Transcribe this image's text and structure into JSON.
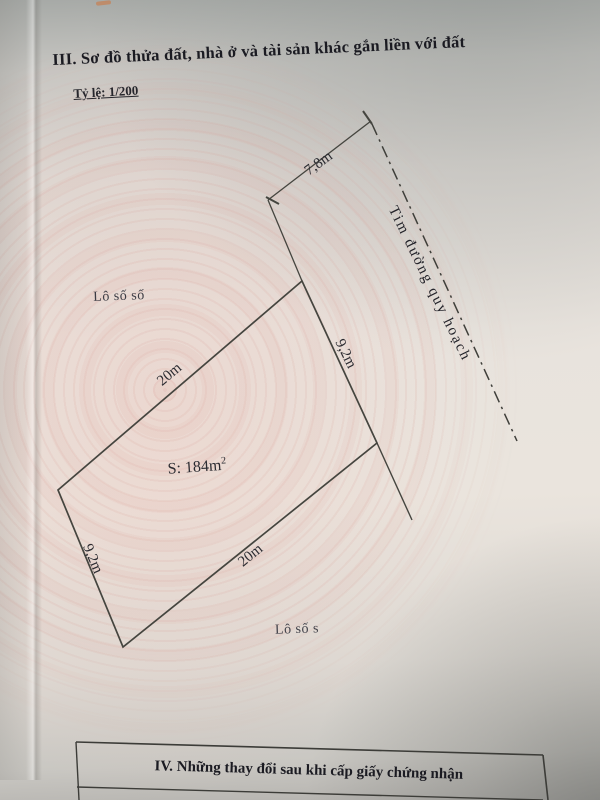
{
  "photo": {
    "section3_heading": "III. Sơ đồ thửa đất, nhà ở và tài sản khác gắn liền với đất",
    "scale_label": "Tỷ lệ: 1/200",
    "diagram": {
      "road_centerline_label": "Tim đường quy hoạch",
      "frontage_offset": "7,8m",
      "edge_top": "20m",
      "side_right": "9,2m",
      "side_left": "9,2m",
      "edge_bottom": "20m",
      "area_label": "S: 184m",
      "area_superscript": "2",
      "adjacent_lot_top": "Lô số số",
      "adjacent_lot_bottom": "Lô số s"
    },
    "section4_heading": "IV. Những thay đổi sau khi cấp giấy chứng nhận"
  }
}
